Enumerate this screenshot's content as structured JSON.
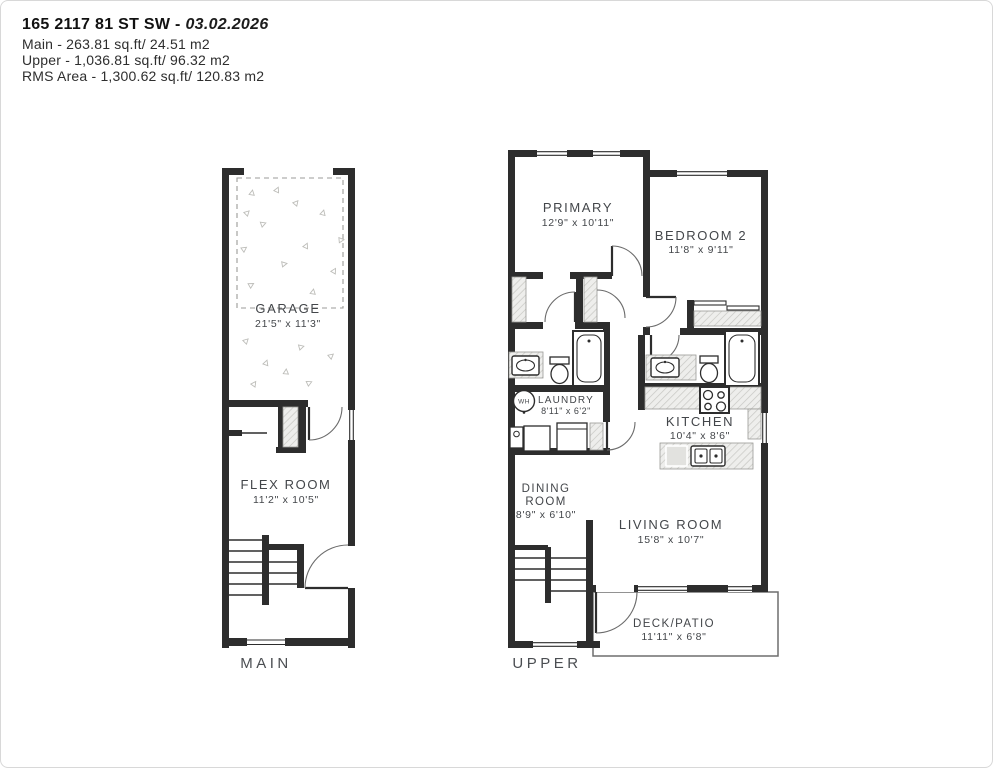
{
  "header": {
    "address": "165 2117 81 ST SW",
    "separator": " - ",
    "date": "03.02.2026",
    "areas": {
      "main": "Main - 263.81 sq.ft/ 24.51 m2",
      "upper": "Upper - 1,036.81 sq.ft/ 96.32 m2",
      "rms": "RMS Area - 1,300.62 sq.ft/ 120.83 m2"
    }
  },
  "plans": {
    "main": {
      "floor_label": "MAIN",
      "garage": {
        "name": "GARAGE",
        "dims": "21'5\" x 11'3\""
      },
      "flex": {
        "name": "FLEX ROOM",
        "dims": "11'2\" x 10'5\""
      }
    },
    "upper": {
      "floor_label": "UPPER",
      "primary": {
        "name": "PRIMARY",
        "dims": "12'9\" x 10'11\""
      },
      "bedroom2": {
        "name": "BEDROOM 2",
        "dims": "11'8\" x 9'11\""
      },
      "laundry": {
        "name": "LAUNDRY",
        "dims": "8'11\" x 6'2\""
      },
      "kitchen": {
        "name": "KITCHEN",
        "dims": "10'4\" x 8'6\""
      },
      "dining": {
        "line1": "DINING",
        "line2": "ROOM",
        "dims": "8'9\" x 6'10\""
      },
      "living": {
        "name": "LIVING ROOM",
        "dims": "15'8\" x 10'7\""
      },
      "deck": {
        "name": "DECK/PATIO",
        "dims": "11'11\" x 6'8\""
      }
    }
  },
  "fixtures": {
    "water_heater": "WH"
  },
  "colors": {
    "wall": "#2d2d2d",
    "text": "#43464a",
    "hatch_line": "#c7c7c3",
    "hatch_bg": "#eeeeec",
    "arc": "#6b6b6b"
  }
}
